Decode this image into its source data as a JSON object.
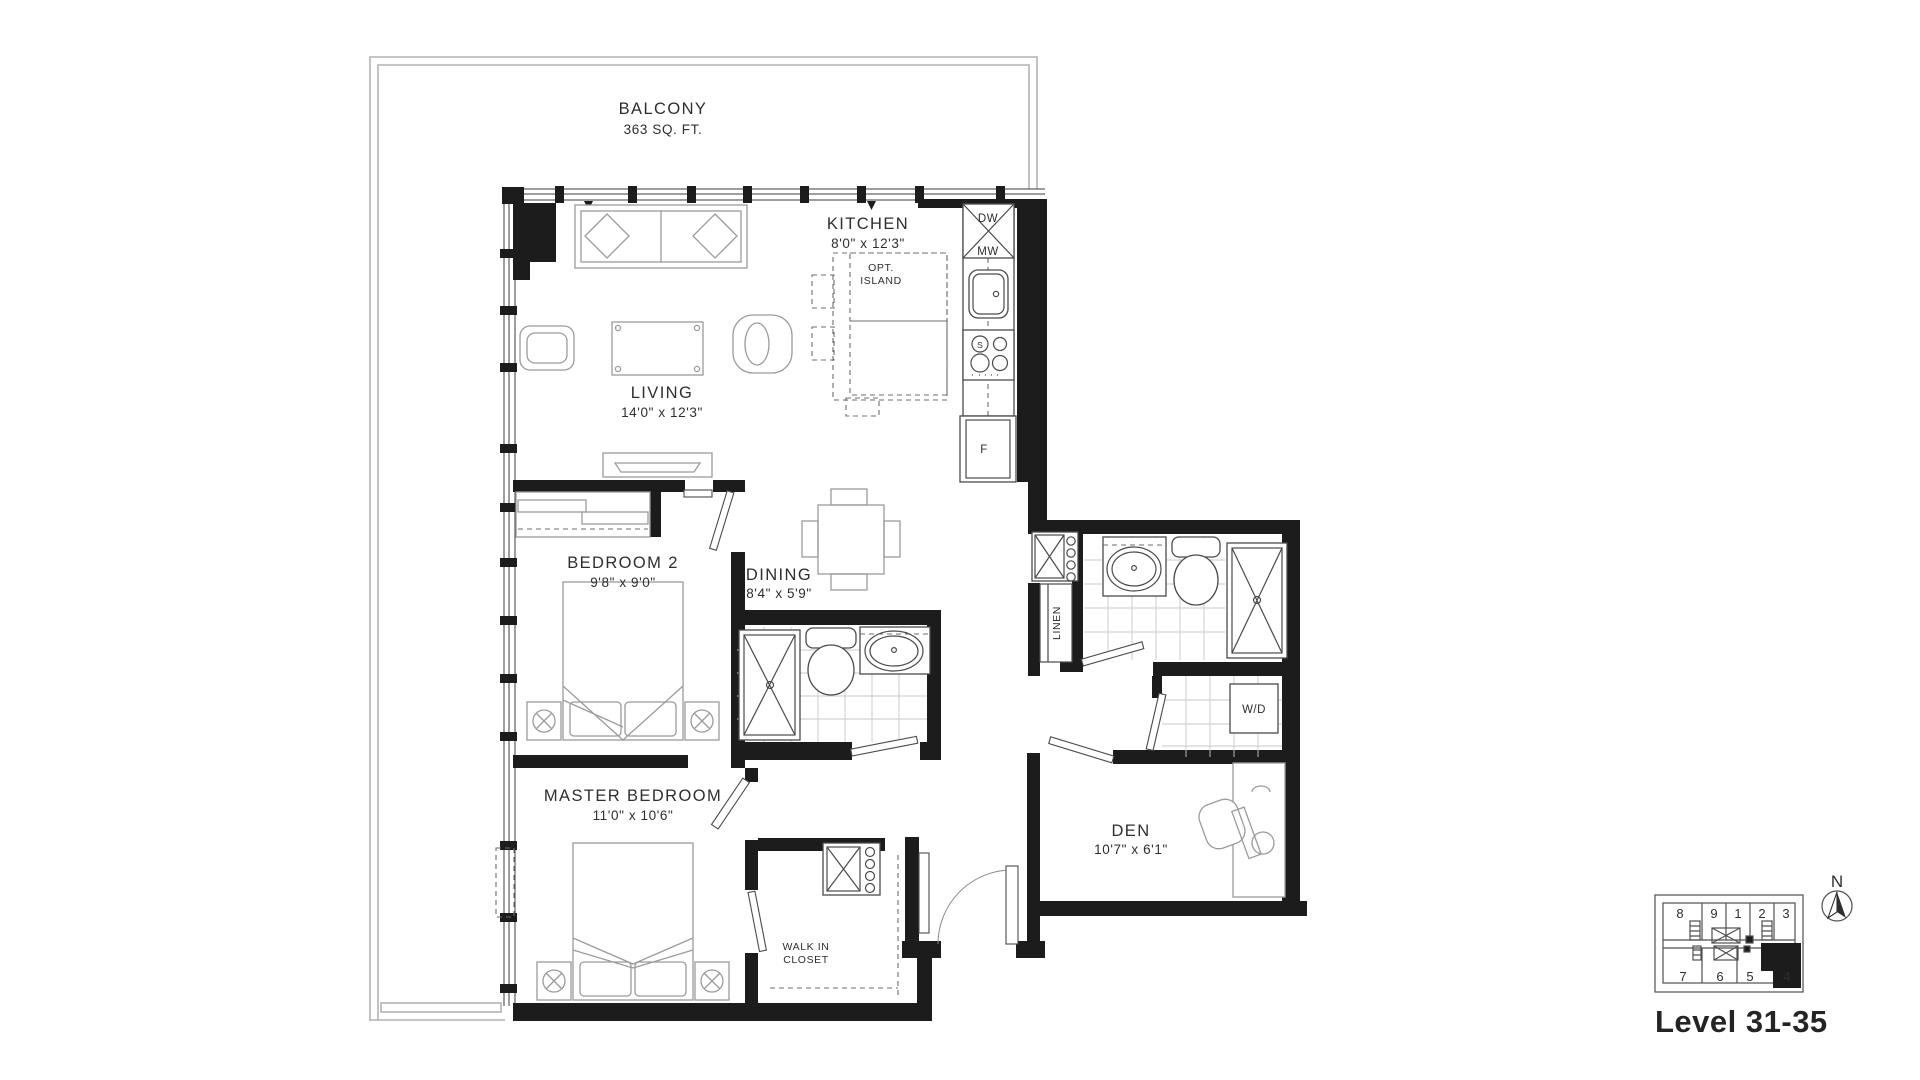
{
  "plan": {
    "balcony": {
      "label": "BALCONY",
      "area": "363 SQ. FT."
    },
    "rooms": {
      "kitchen": {
        "label": "KITCHEN",
        "dims": "8'0\" x 12'3\""
      },
      "living": {
        "label": "LIVING",
        "dims": "14'0\" x 12'3\""
      },
      "bedroom2": {
        "label": "BEDROOM 2",
        "dims": "9'8\" x 9'0\""
      },
      "dining": {
        "label": "DINING",
        "dims": "8'4\" x 5'9\""
      },
      "master_bedroom": {
        "label": "MASTER BEDROOM",
        "dims": "11'0\" x 10'6\""
      },
      "den": {
        "label": "DEN",
        "dims": "10'7\" x 6'1\""
      },
      "walk_in_closet": {
        "line1": "WALK IN",
        "line2": "CLOSET"
      },
      "linen": {
        "label": "LINEN"
      },
      "laundry": {
        "label": "W/D"
      }
    },
    "kitchen_labels": {
      "dishwasher": "DW",
      "microwave": "MW",
      "stove": "S",
      "fridge": "F",
      "island_line1": "OPT.",
      "island_line2": "ISLAND"
    }
  },
  "keyplan": {
    "north_label": "N",
    "level_label": "Level 31-35",
    "units_top": [
      "8",
      "9",
      "1",
      "2",
      "3"
    ],
    "units_bottom": [
      "7",
      "6",
      "5",
      "4"
    ],
    "highlighted_unit": "4"
  },
  "colors": {
    "walls": "#1c1c1c",
    "text": "#2e2e2e",
    "fixtures": "#4a4a4a",
    "furniture": "#9b9b9b",
    "tile": "#c9c9c9",
    "balcony_line": "#b4b4b4"
  }
}
